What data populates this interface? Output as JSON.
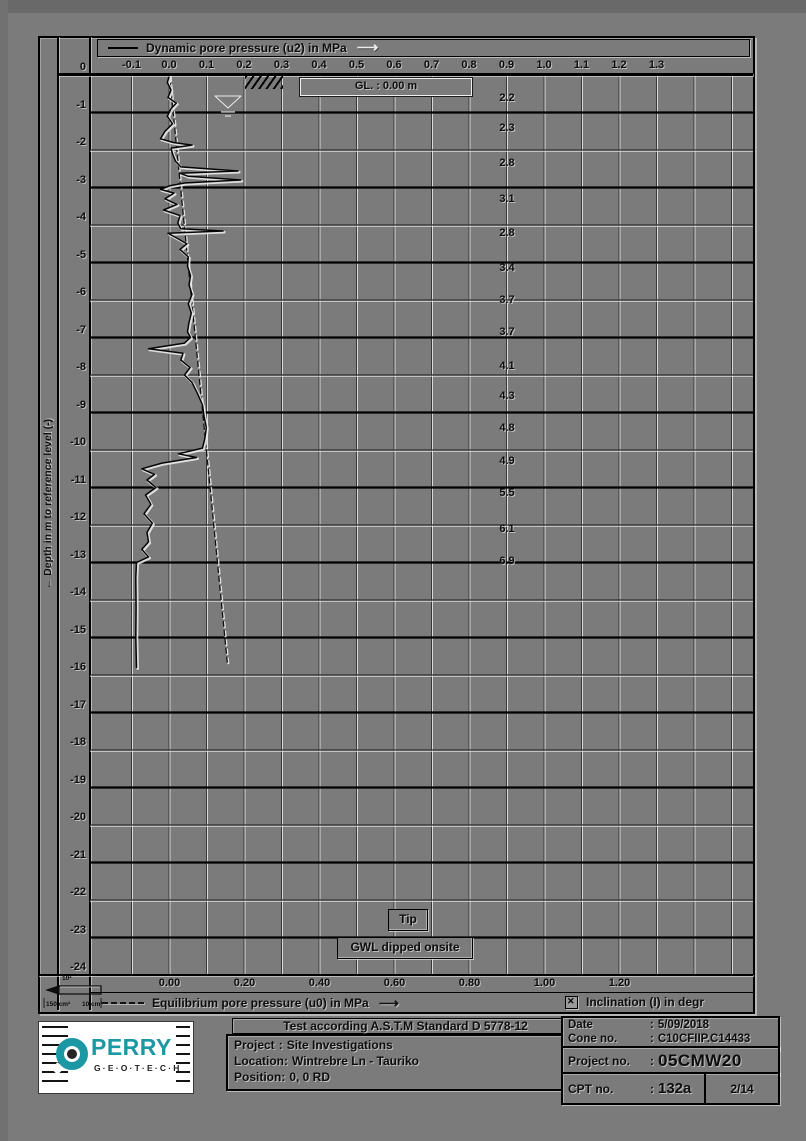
{
  "page": {
    "background": "#7b7b7b",
    "accent_teal": "#1b98a4"
  },
  "left_axis": {
    "title": "←  Depth in m to reference level (-)"
  },
  "legend_top": {
    "label": "Dynamic pore pressure (u2) in MPa",
    "arrow": "⟶"
  },
  "legend_bottom": {
    "u0_label": "Equilibrium pore pressure (u0) in MPa",
    "arrow": "⟶",
    "inclination_label": "Inclination (I) in degr"
  },
  "cone_schematic": {
    "label_top": "10²",
    "label_left": "150 cm²",
    "label_right": "10 cm²"
  },
  "logo": {
    "brand": "PERRY",
    "sub": "G·E·O·T·E·C·H"
  },
  "footer": {
    "standard": "Test according A.S.T.M Standard D 5778-12",
    "project_label": "Project",
    "project_value": "Site Investigations",
    "location_label": "Location:",
    "location_value": "Wintrebre Ln - Tauriko",
    "position_label": "Position:",
    "position_value": "0, 0 RD",
    "date_label": "Date",
    "date_value": "5/09/2018",
    "cone_label": "Cone no.",
    "cone_value": "C10CFIIP.C14433",
    "projectno_label": "Project no.",
    "projectno_value": "05CMW20",
    "cptno_label": "CPT no.",
    "cptno_value": "132a",
    "sheet": "2/14",
    "colon": ":"
  },
  "chart_data": {
    "type": "line",
    "title": "Dynamic pore pressure (u2) in MPa",
    "x_axis_top": {
      "label": "Dynamic pore pressure (u2) in MPa",
      "unit": "MPa",
      "ticks": [
        "-0.1",
        "0.0",
        "0.1",
        "0.2",
        "0.3",
        "0.4",
        "0.5",
        "0.6",
        "0.7",
        "0.8",
        "0.9",
        "1.0",
        "1.1",
        "1.2",
        "1.3"
      ],
      "range": [
        -0.21,
        1.56
      ],
      "grid": true
    },
    "x_axis_bottom": {
      "label": "Equilibrium pore pressure (u0) in MPa",
      "ticks": [
        "0.00",
        "0.20",
        "0.40",
        "0.60",
        "0.80",
        "1.00",
        "1.20"
      ]
    },
    "y_axis": {
      "label": "Depth in m to reference level (-)",
      "ticks": [
        "0",
        "-1",
        "-2",
        "-3",
        "-4",
        "-5",
        "-6",
        "-7",
        "-8",
        "-9",
        "-10",
        "-11",
        "-12",
        "-13",
        "-14",
        "-15",
        "-16",
        "-17",
        "-18",
        "-19",
        "-20",
        "-21",
        "-22",
        "-23",
        "-24"
      ],
      "range": [
        0,
        -24
      ]
    },
    "annotations": {
      "gl": "GL. :  0.00  m",
      "tip": "Tip",
      "gwl": "GWL dipped onsite"
    },
    "series": [
      {
        "name": "Dynamic pore pressure (u2)",
        "style": "solid",
        "unit": "MPa",
        "points_depth_value": [
          [
            0.0,
            0.0
          ],
          [
            0.2,
            -0.006
          ],
          [
            0.4,
            0.004
          ],
          [
            0.6,
            -0.004
          ],
          [
            0.75,
            0.018
          ],
          [
            0.9,
            0.004
          ],
          [
            1.1,
            -0.006
          ],
          [
            1.3,
            0.008
          ],
          [
            1.5,
            -0.012
          ],
          [
            1.7,
            -0.024
          ],
          [
            1.8,
            0.01
          ],
          [
            1.87,
            0.06
          ],
          [
            1.95,
            0.004
          ],
          [
            2.1,
            0.008
          ],
          [
            2.3,
            0.016
          ],
          [
            2.45,
            0.03
          ],
          [
            2.56,
            0.183
          ],
          [
            2.62,
            0.028
          ],
          [
            2.7,
            0.05
          ],
          [
            2.8,
            0.19
          ],
          [
            2.88,
            0.04
          ],
          [
            2.95,
            0.002
          ],
          [
            3.05,
            -0.024
          ],
          [
            3.15,
            0.012
          ],
          [
            3.3,
            -0.012
          ],
          [
            3.45,
            0.02
          ],
          [
            3.6,
            -0.016
          ],
          [
            3.75,
            0.028
          ],
          [
            3.95,
            0.022
          ],
          [
            4.1,
            0.03
          ],
          [
            4.16,
            0.143
          ],
          [
            4.22,
            -0.004
          ],
          [
            4.35,
            0.02
          ],
          [
            4.5,
            0.046
          ],
          [
            4.65,
            0.028
          ],
          [
            4.85,
            0.05
          ],
          [
            5.1,
            0.048
          ],
          [
            5.35,
            0.056
          ],
          [
            5.6,
            0.052
          ],
          [
            5.85,
            0.06
          ],
          [
            6.1,
            0.05
          ],
          [
            6.35,
            0.058
          ],
          [
            6.6,
            0.052
          ],
          [
            6.85,
            0.048
          ],
          [
            7.0,
            0.056
          ],
          [
            7.15,
            0.04
          ],
          [
            7.3,
            -0.056
          ],
          [
            7.42,
            0.036
          ],
          [
            7.6,
            0.03
          ],
          [
            7.8,
            0.055
          ],
          [
            8.0,
            0.04
          ],
          [
            8.2,
            0.06
          ],
          [
            8.5,
            0.075
          ],
          [
            8.8,
            0.088
          ],
          [
            9.1,
            0.092
          ],
          [
            9.4,
            0.098
          ],
          [
            9.7,
            0.094
          ],
          [
            9.95,
            0.088
          ],
          [
            10.1,
            0.024
          ],
          [
            10.2,
            0.072
          ],
          [
            10.35,
            -0.02
          ],
          [
            10.5,
            -0.074
          ],
          [
            10.65,
            -0.04
          ],
          [
            10.8,
            -0.06
          ],
          [
            11.0,
            -0.036
          ],
          [
            11.2,
            -0.064
          ],
          [
            11.45,
            -0.05
          ],
          [
            11.7,
            -0.068
          ],
          [
            11.95,
            -0.046
          ],
          [
            12.2,
            -0.06
          ],
          [
            12.45,
            -0.056
          ],
          [
            12.65,
            -0.074
          ],
          [
            12.85,
            -0.056
          ],
          [
            13.0,
            -0.088
          ],
          [
            13.4,
            -0.09
          ],
          [
            14.2,
            -0.089
          ],
          [
            15.0,
            -0.09
          ],
          [
            15.8,
            -0.088
          ]
        ]
      },
      {
        "name": "Equilibrium pore pressure (u0)",
        "style": "dashed",
        "unit": "MPa",
        "points_depth_value": [
          [
            0.0,
            0.0
          ],
          [
            15.75,
            0.155
          ]
        ]
      },
      {
        "name": "Inclination (I)",
        "style": "text-column",
        "unit": "degr",
        "position_mpa": 0.9,
        "points_depth_value": [
          [
            0.6,
            2.2
          ],
          [
            1.4,
            2.3
          ],
          [
            2.35,
            2.8
          ],
          [
            3.3,
            3.1
          ],
          [
            4.2,
            2.8
          ],
          [
            5.15,
            3.4
          ],
          [
            6.0,
            3.7
          ],
          [
            6.85,
            3.7
          ],
          [
            7.75,
            4.1
          ],
          [
            8.55,
            4.3
          ],
          [
            9.4,
            4.8
          ],
          [
            10.3,
            4.9
          ],
          [
            11.15,
            5.5
          ],
          [
            12.1,
            6.1
          ],
          [
            12.95,
            6.9
          ]
        ]
      }
    ]
  }
}
